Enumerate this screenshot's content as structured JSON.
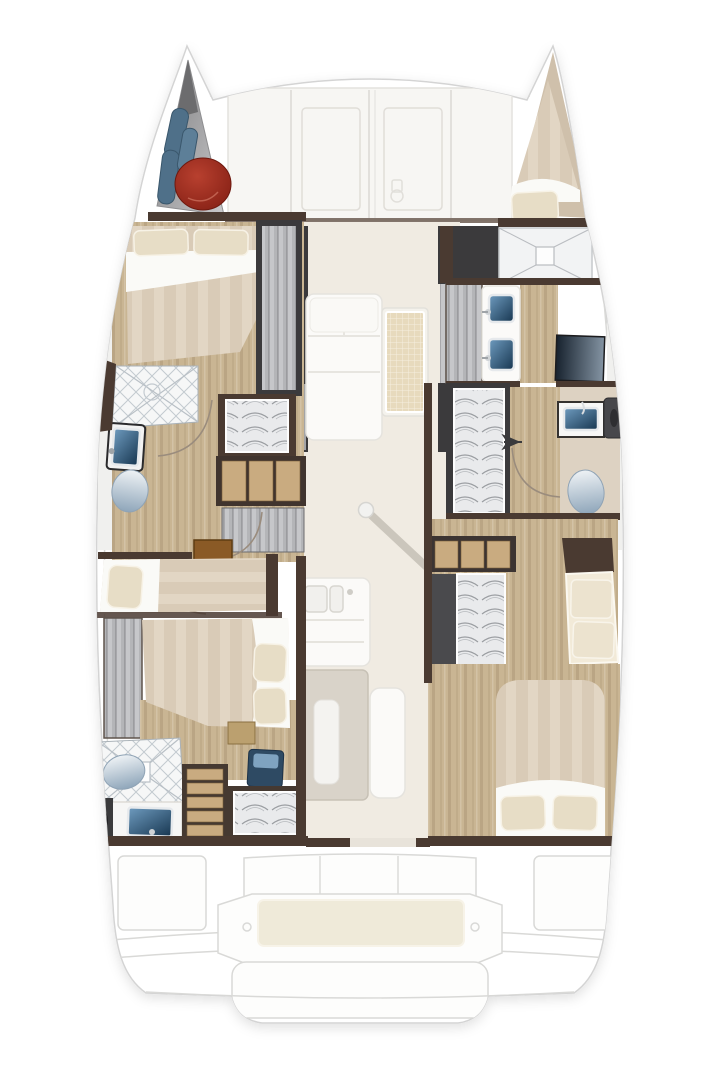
{
  "figure": {
    "kind": "catamaran-interior-floor-plan",
    "orientation": "bow-top",
    "text_on_image": ""
  },
  "palette": {
    "wall": "#4a3a31",
    "charcoal": "#3b3a3c",
    "wood": "#c9b593",
    "woodDark": "#b39e7c",
    "floorSaloon": "#f0ebe2",
    "floorBath": "#ddd2c2",
    "ghostLine": "#d9d9d7",
    "pillow": "#e7ddc6",
    "sheet": "#fafaf7",
    "cushion": "#ece3cf",
    "duvet": "#d9cbb7",
    "duvetLight": "#e2d6c4",
    "grayPanel": "#b4b5b8",
    "grayPanelLight": "#c6c7ca",
    "stepTan": "#c9ab80",
    "island": "#d9d3c9",
    "seatBlue": "#2e4a63",
    "sinkNavy": "#16354f",
    "sinkNavyLight": "#6f9cc0",
    "toiletLight": "#eef2f5",
    "toiletDark": "#8fa6ba",
    "fenderBlue": "#4f7089",
    "bagRed": "#9e2e22",
    "tvDark": "#17222e",
    "tvLight": "#8494a3",
    "nightstandWood": "#8a5a26"
  },
  "features": [
    "port-bow-locker-with-fenders-and-bag",
    "starboard-bow-berth",
    "forward-cockpit-lounge",
    "saloon-sofa",
    "saloon-table",
    "mast-post",
    "galley-sink-unit",
    "galley-island",
    "galley-bench",
    "port-forward-cabin-double-bed",
    "port-forward-head-shower-sink-toilet",
    "port-wardrobe",
    "port-drawers",
    "port-aft-single-berth",
    "port-aft-double-bed",
    "port-aft-head",
    "starboard-escape-hatch",
    "starboard-double-vanity",
    "starboard-tv",
    "starboard-head-sink-toilet",
    "starboard-wardrobes",
    "starboard-drawers",
    "starboard-bench-seat",
    "starboard-aft-double-bed",
    "aft-cockpit-bench",
    "swim-platform"
  ]
}
